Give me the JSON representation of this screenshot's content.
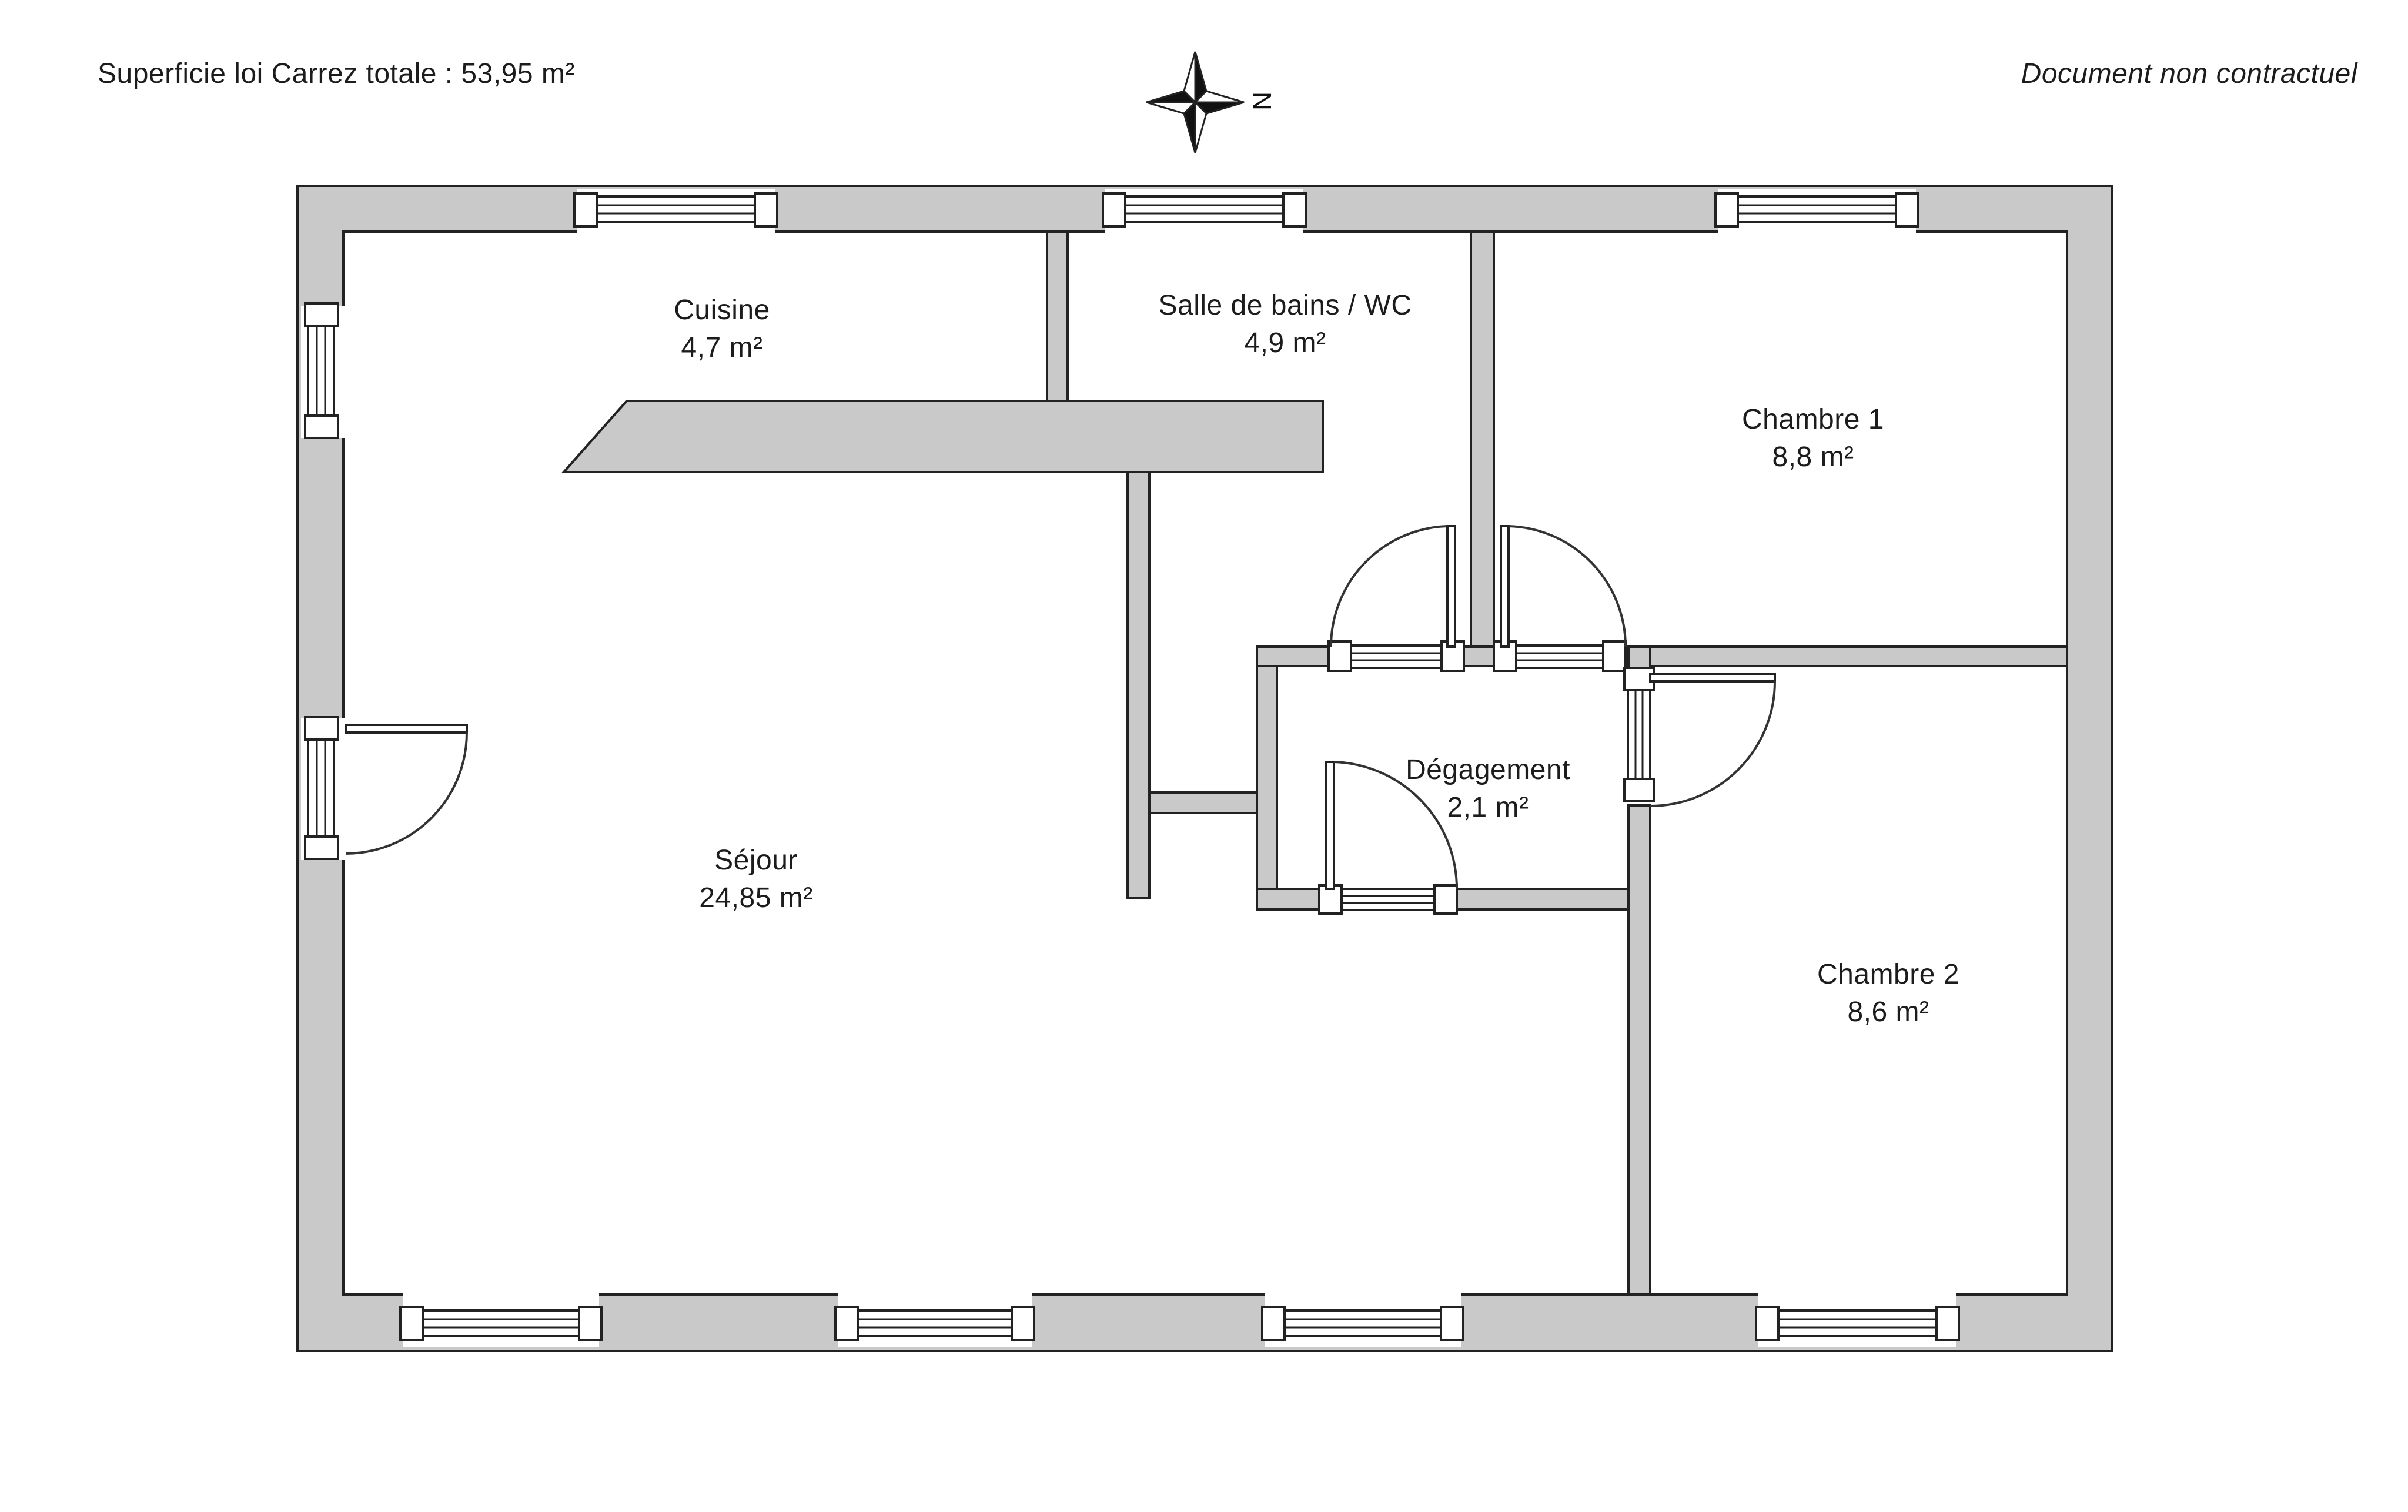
{
  "header": {
    "left": "Superficie loi Carrez totale : 53,95 m²",
    "right": "Document non contractuel"
  },
  "compass": {
    "label": "N"
  },
  "rooms": {
    "cuisine": {
      "name": "Cuisine",
      "area": "4,7 m²"
    },
    "salle_de_bains": {
      "name": "Salle de bains / WC",
      "area": "4,9 m²"
    },
    "chambre1": {
      "name": "Chambre 1",
      "area": "8,8 m²"
    },
    "degagement": {
      "name": "Dégagement",
      "area": "2,1 m²"
    },
    "sejour": {
      "name": "Séjour",
      "area": "24,85 m²"
    },
    "chambre2": {
      "name": "Chambre 2",
      "area": "8,6 m²"
    }
  },
  "colors": {
    "wall_fill": "#c9c9c9",
    "line": "#222222",
    "background": "#ffffff"
  }
}
